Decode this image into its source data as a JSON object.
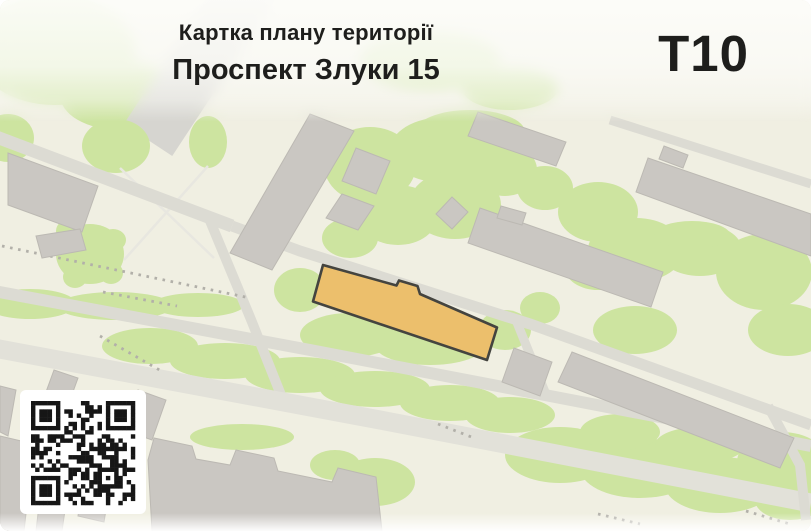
{
  "header": {
    "subtitle": "Картка плану території",
    "title": "Проспект Злуки 15",
    "sheet_code": "Т10"
  },
  "map": {
    "type": "city-plan",
    "highlighted_building": "target-parcel-building"
  },
  "icons": {
    "qr": "qr-code-icon"
  },
  "colors": {
    "bg": "#f0efe2",
    "green": "#cde4a0",
    "road": "#dcdbd3",
    "road_wide": "#e2e1d9",
    "road_thin": "#e8e7e0",
    "road_decor": "#d6d5d0",
    "building": "#cac7c2",
    "building_stroke": "#bcb9b3",
    "dotted": "#b2b0a9",
    "highlight": "#ecbf6c",
    "highlight_stroke": "#44443f",
    "qr": "#161616",
    "text": "#1e1e1c",
    "card": "#ffffff"
  }
}
